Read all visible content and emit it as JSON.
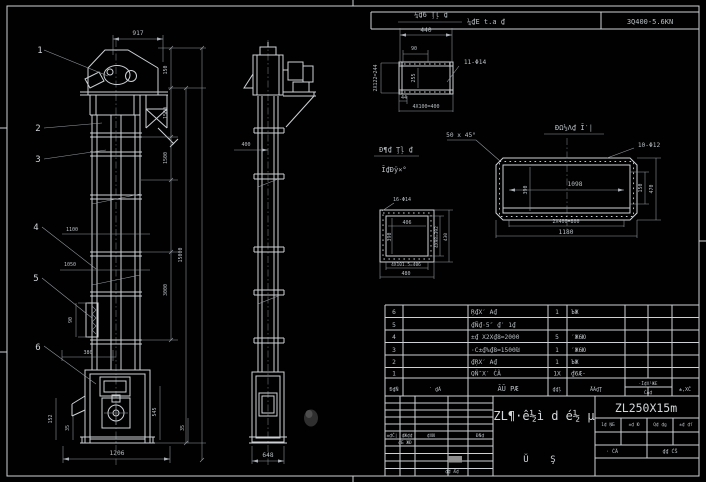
{
  "header": {
    "model_note": "¼₫E t.a ₫",
    "model_code": "3Q400-5.6KN"
  },
  "front_view": {
    "balloons": [
      "1",
      "2",
      "3",
      "4",
      "5",
      "6"
    ],
    "dim_top": "917",
    "dims_right": [
      "150",
      "1500",
      "1500",
      "3000",
      "15000"
    ],
    "dims_left": [
      "1100",
      "1050",
      "90",
      "380",
      "152",
      "35",
      "1206"
    ],
    "dims_boot_right": [
      "545",
      "35"
    ]
  },
  "side_view": {
    "dim_mid": "400",
    "dim_bottom": "648"
  },
  "flange_detail": {
    "title": "¼₫6 Ţļ ₫",
    "dim_width": "440",
    "dim_offset": "90",
    "holes": "11-Φ14",
    "dim_left": "2X122=244",
    "dim_inner": "255",
    "dim_bottom_small": "44",
    "dim_bottom": "4X100=400"
  },
  "chamfer_note": "50 x 45°",
  "long_detail": {
    "title": "ĐΩ½Λ₫ Ī′|",
    "holes": "10-Φ12",
    "dim_inner_w": "1098",
    "dim_inner_h": "390",
    "dim_right_inner": "150",
    "dim_right_outer": "470",
    "dim_bottom_1": "2X400=800",
    "dim_bottom_2": "1180"
  },
  "square_detail": {
    "title_1": "Đ¶₫ Ţļ ₫",
    "title_2": "Ĩ₫Đÿ×°",
    "holes": "16-Φ14",
    "dim_inner_w": "406",
    "dim_inner_h": "390",
    "dim_right_1": "4X98=392",
    "dim_right_2": "430",
    "dim_bottom_1": "4X101.5=406",
    "dim_bottom_2": "480"
  },
  "bom": {
    "headers": {
      "no": "Đ₫Ñ",
      "code": "′ ₫Ã",
      "name": "ÃŨ PÆ",
      "qty": "₫₫ļ",
      "material": "ĀÃ₫Ţ",
      "weight": "·Ī₫X¹ЖE",
      "weight_sub": "ĆÃ₫",
      "note": "±‚XČ"
    },
    "rows": [
      {
        "no": "6",
        "name": "Ŗ₫X′ A₫",
        "qty": "1",
        "material": "ЪЖ"
      },
      {
        "no": "5",
        "name": "₫Ñ₫·5″ ₫′ 1₫",
        "qty": "",
        "material": ""
      },
      {
        "no": "4",
        "name": "±₫ X2X₫8=2000",
        "qty": "5",
        "material": "′Ж6Ю"
      },
      {
        "no": "3",
        "name": "·C±₫%₫8=1500₪",
        "qty": "1",
        "material": "′Ж6Ю"
      },
      {
        "no": "2",
        "name": "₫ŖX′ A₫",
        "qty": "1",
        "material": "ЪЖ"
      },
      {
        "no": "1",
        "name": "QÑ″X′ ĆÃ",
        "qty": "1X",
        "material": "₫6Æ·"
      }
    ]
  },
  "titleblock": {
    "drawing_title": "ZL¶·ê½ì d é½ µ",
    "model": "ZL250X15m",
    "left_header": [
      "±₫Č|",
      "₫Ж₫₫",
      "₫XЮ",
      "ĐÑ₫"
    ],
    "left_row": "₫Б ЖĐ",
    "left_bottom": "₫₫ Æ₫",
    "mid_glyph_1": "Ŭ",
    "mid_glyph_2": "Ş",
    "right_cells": [
      "1₫ ŅБ",
      "±₫ Ю",
      "Q₫ ₫g",
      "±₫ ₫ſ"
    ],
    "scale_label": "· ĆÃ",
    "sheet_label": "₫₫ ĆŠ"
  }
}
